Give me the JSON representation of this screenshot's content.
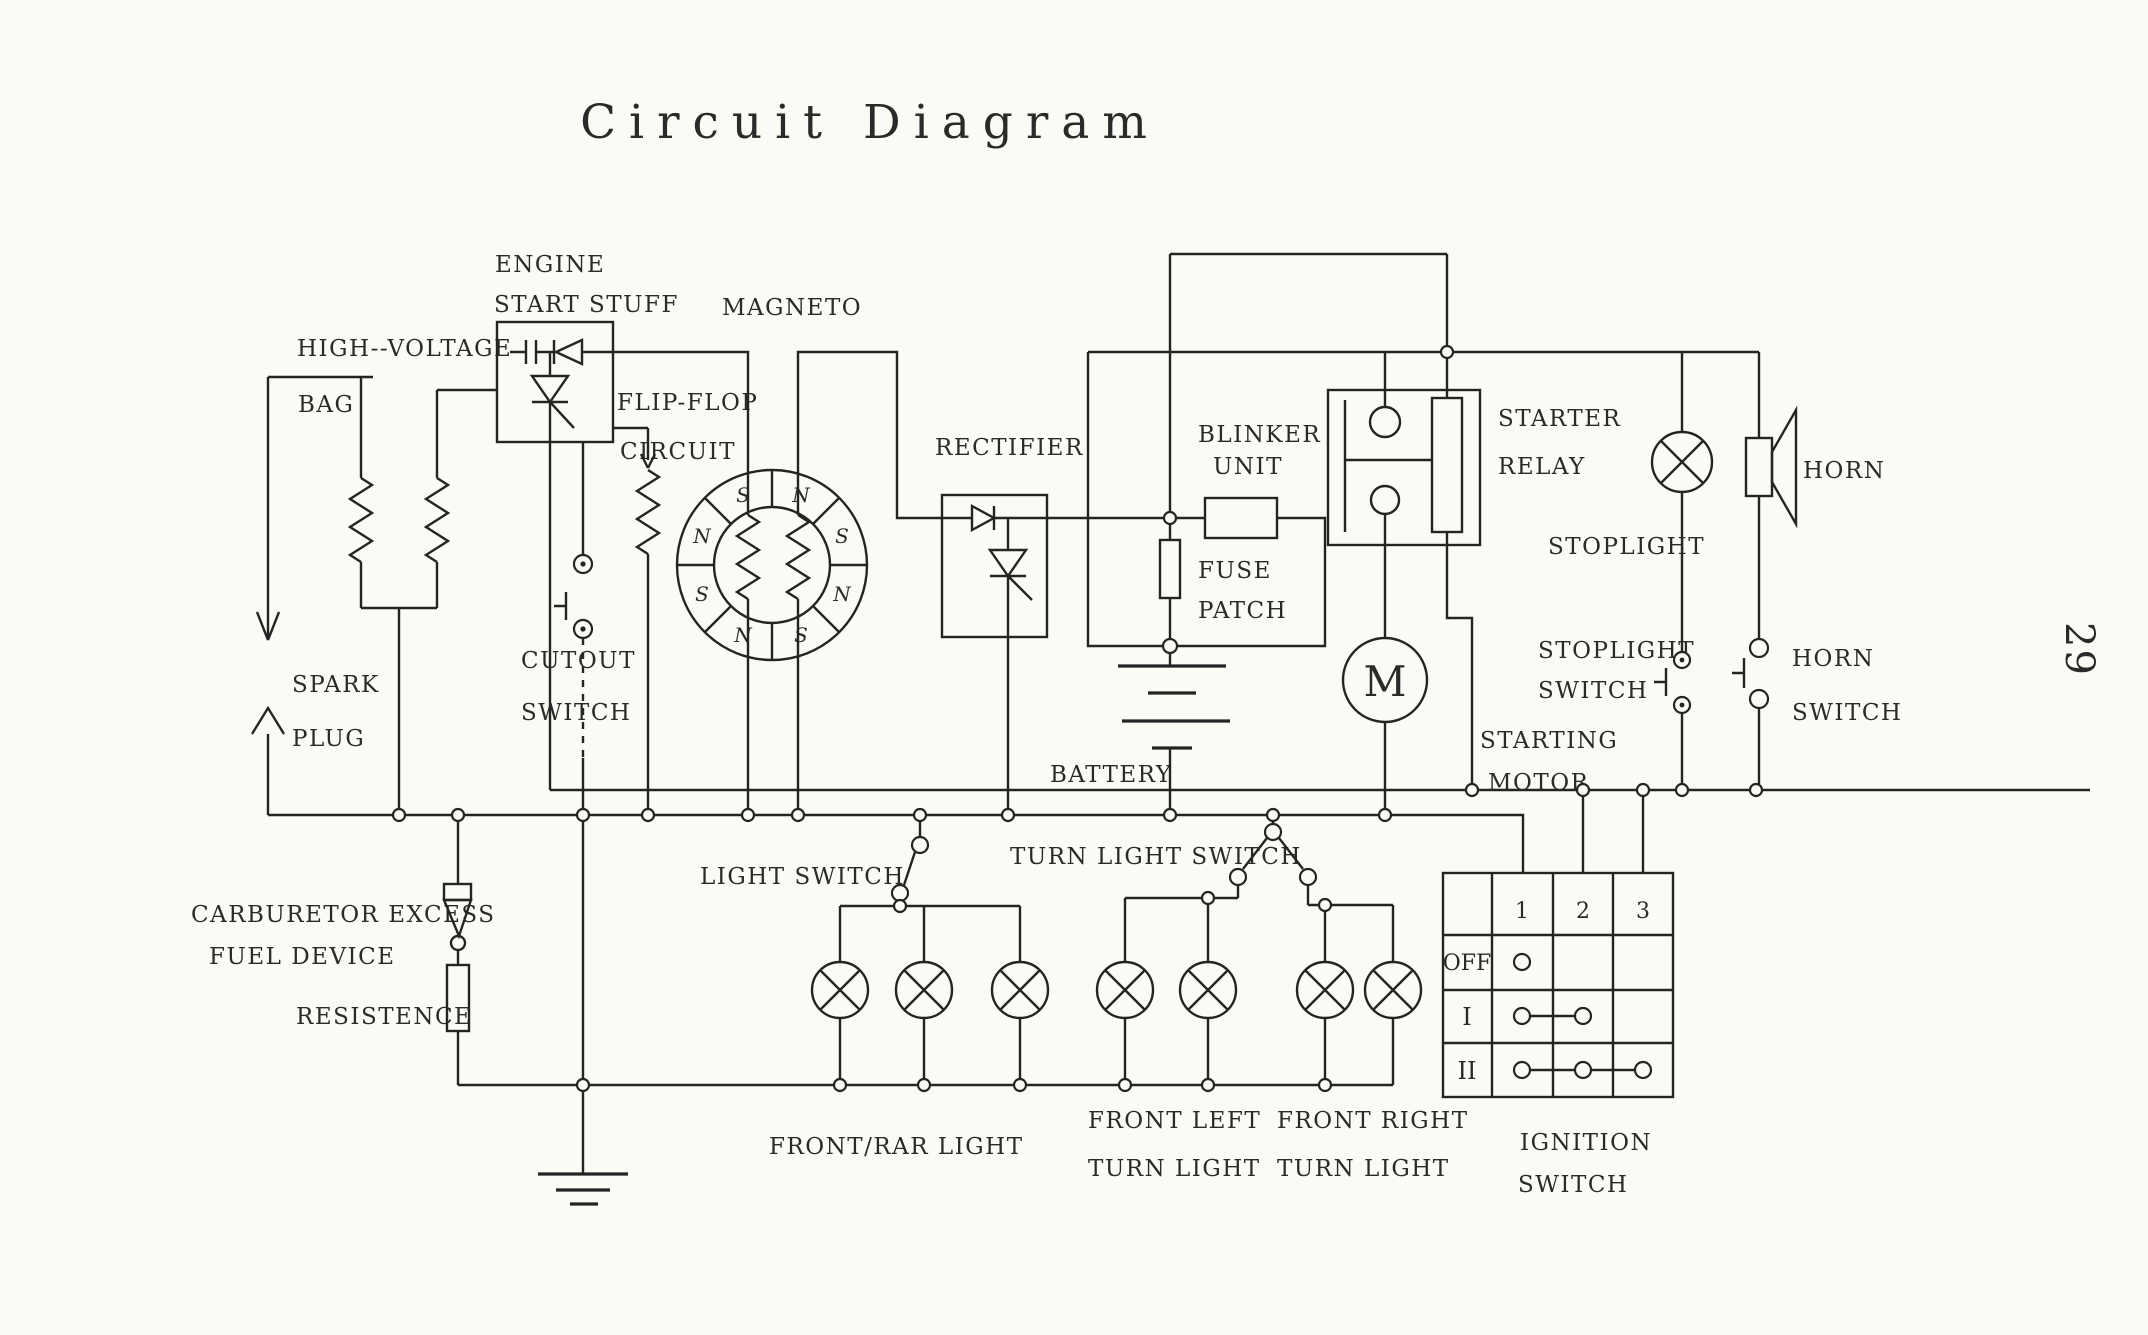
{
  "title": "Circuit Diagram",
  "page_number": "29",
  "colors": {
    "ink": "#242424",
    "paper": "#fbfaf4"
  },
  "components": {
    "high_voltage_bag": {
      "line1": "HIGH--VOLTAGE",
      "line2": "BAG"
    },
    "spark_plug": {
      "line1": "SPARK",
      "line2": "PLUG"
    },
    "engine_start_stuff": {
      "line1": "ENGINE",
      "line2": "START STUFF"
    },
    "flip_flop": {
      "line1": "FLIP-FLOP",
      "line2": "CIRCUIT"
    },
    "magneto": {
      "label": "MAGNETO",
      "pole_letters": [
        "N",
        "S",
        "N",
        "S",
        "N",
        "S",
        "N",
        "S"
      ]
    },
    "cutout_switch": {
      "line1": "CUTOUT",
      "line2": "SWITCH"
    },
    "rectifier": {
      "label": "RECTIFIER"
    },
    "blinker_unit": {
      "line1": "BLINKER",
      "line2": "UNIT"
    },
    "fuse_patch": {
      "line1": "FUSE",
      "line2": "PATCH"
    },
    "battery": {
      "label": "BATTERY"
    },
    "starter_relay": {
      "line1": "STARTER",
      "line2": "RELAY"
    },
    "starting_motor": {
      "line1": "STARTING",
      "line2": "MOTOR",
      "symbol": "M"
    },
    "stoplight": {
      "label": "STOPLIGHT"
    },
    "horn": {
      "label": "HORN"
    },
    "stoplight_switch": {
      "line1": "STOPLIGHT",
      "line2": "SWITCH"
    },
    "horn_switch": {
      "line1": "HORN",
      "line2": "SWITCH"
    },
    "turn_light_switch": {
      "label": "TURN LIGHT SWITCH"
    },
    "light_switch": {
      "label": "LIGHT SWITCH"
    },
    "carburetor_excess_fuel_device": {
      "line1": "CARBURETOR EXCESS",
      "line2": "FUEL DEVICE"
    },
    "resistence": {
      "label": "RESISTENCE"
    },
    "front_rar_light": {
      "label": "FRONT/RAR LIGHT"
    },
    "front_left_turn_light": {
      "line1": "FRONT LEFT",
      "line2": "TURN LIGHT"
    },
    "front_right_turn_light": {
      "line1": "FRONT RIGHT",
      "line2": "TURN LIGHT"
    },
    "ignition_switch": {
      "line1": "IGNITION",
      "line2": "SWITCH",
      "columns": [
        "1",
        "2",
        "3"
      ],
      "rows": [
        {
          "label": "OFF",
          "contacts": [
            1
          ]
        },
        {
          "label": "I",
          "contacts": [
            1,
            2
          ]
        },
        {
          "label": "II",
          "contacts": [
            1,
            2,
            3
          ]
        }
      ]
    }
  }
}
